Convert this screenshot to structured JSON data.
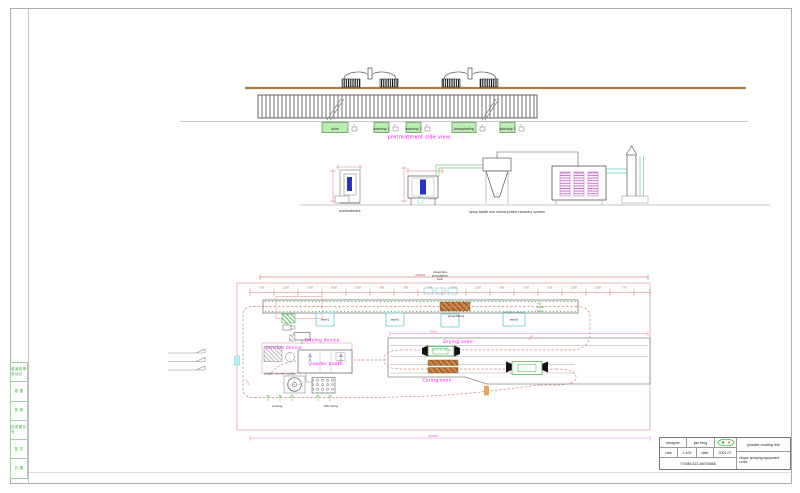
{
  "sheet": {
    "left_strip_cells": [
      "增减改等变动记",
      "描 图",
      "校 核",
      "旧底图总号",
      "签 字",
      "日 期"
    ]
  },
  "side_view": {
    "title": "pretreatment side view",
    "tank_labels": [
      "skim",
      "washing 1",
      "washing 2",
      "phosphating",
      "washing 3"
    ]
  },
  "elevation": {
    "pretreatment_label": "pretreatment",
    "booth_label": "spray booth and monocyclone recovery system"
  },
  "plan": {
    "phosphate_note": [
      "phosphate",
      "precipitation",
      "tank"
    ],
    "hot_water_note": [
      "hot",
      "water",
      "tank"
    ],
    "wash1": "wash1",
    "wash2": "wash2",
    "phosphating": "phosphating",
    "wash3": "wash3",
    "driving_device": "Driving device",
    "tension_device": "tension device",
    "powder_booth": "powder booth",
    "powder_recovery": "powder recovery system",
    "loading": "Loading",
    "off_loading": "Off loading",
    "drying_oven": "Drying oven",
    "curing_oven": "Curing oven",
    "dims": {
      "overall": "21654",
      "oven": "7500",
      "bottom": "20000",
      "diag1": "1500",
      "diag2": "1500",
      "diag3": "1500",
      "ticks": [
        "750",
        "2250",
        "1700",
        "3000",
        "1950",
        "900",
        "800",
        "900",
        "1443",
        "1200",
        "900",
        "1700",
        "620",
        "2500",
        "1500",
        "775"
      ]
    }
  },
  "title_block": {
    "designer_label": "designer",
    "designer_value": "jiao feng",
    "rate_label": "rate",
    "rate_value": "1:100",
    "date_label": "date",
    "date_value": "2001.07",
    "phone": "T:0086-523-88793666",
    "product": "powder coating line",
    "company": "xinyue spraying equipment co.ltd"
  },
  "colors": {
    "label_magenta": "#ff00ff",
    "dimension_red": "#cc3333",
    "dimension_pink": "#e678d8",
    "note_green": "#2fae2f",
    "tank_cyan": "#66cccc",
    "rail_brown": "#b07b3e",
    "tank_fill_green": "#b9eeb0",
    "part_blue": "#2535cc"
  }
}
